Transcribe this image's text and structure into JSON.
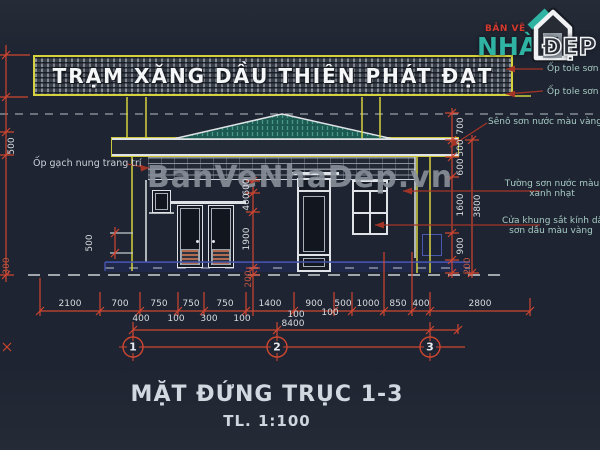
{
  "sign": {
    "text": "TRẠM XĂNG DẦU THIÊN PHÁT ĐẠT"
  },
  "logo": {
    "line1": "BẢN VẼ",
    "line2": "NHÀ",
    "line3": "ĐẸP"
  },
  "watermark": "BanVeNhaDep.vn",
  "title": {
    "main": "MẶT ĐỨNG TRỤC 1-3",
    "scale": "TL. 1:100"
  },
  "notes": {
    "left_wall": "Ốp gạch nung trang trí",
    "tole_1": "Ốp tole sơn d",
    "tole_2": "Ốp tole sơn d",
    "seno": "Sênô sơn nước màu vàng cam",
    "wall_1": "Tường sơn nước màu",
    "wall_2": "xanh nhạt",
    "door_1": "Cửa khung sắt kính dầy 5",
    "door_2": "sơn dầu màu vàng"
  },
  "axes": {
    "a1": "1",
    "a2": "2",
    "a3": "3"
  },
  "dims": {
    "bottom": [
      "2100",
      "700",
      "750",
      "750",
      "750",
      "1400",
      "900",
      "500",
      "1000",
      "850",
      "400",
      "2800"
    ],
    "bottom_sub": [
      "400",
      "100",
      "300",
      "100",
      "100",
      "100"
    ],
    "total": "8400",
    "left": [
      "500",
      "300"
    ],
    "step": "500",
    "center": [
      "600",
      "400",
      "1900",
      "200"
    ],
    "right": [
      "700",
      "500",
      "600",
      "1600",
      "900",
      "200"
    ],
    "right_total": "3800"
  },
  "colors": {
    "background": "#1e2431",
    "dim_red": "#cf4631",
    "leader_red": "#a33527",
    "yellow": "#d6d23d",
    "note_cyan": "#a7ccc5",
    "navy": "#4250a5",
    "roof_teal": "#1c5950",
    "logo_teal": "#2fb3a2",
    "logo_red": "#d6392e"
  }
}
